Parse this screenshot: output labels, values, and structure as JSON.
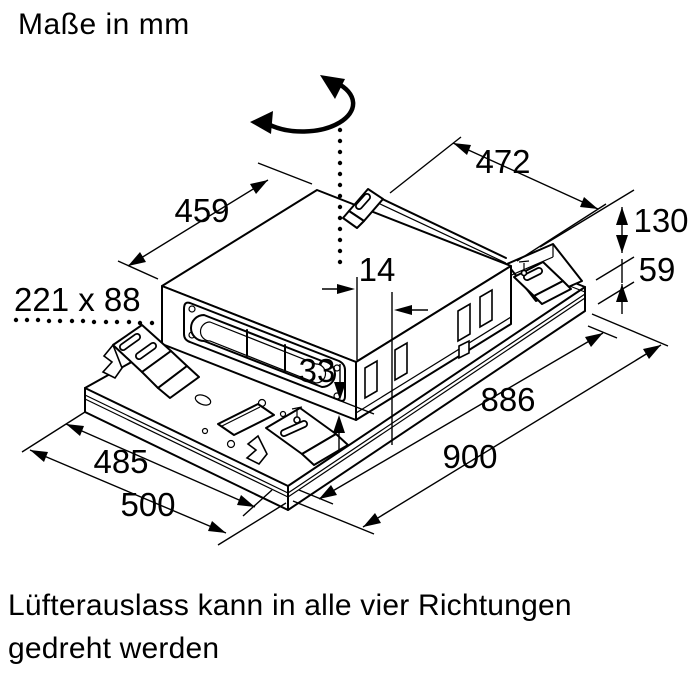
{
  "title": "Maße in mm",
  "caption": {
    "line1": "Lüfterauslass kann in alle vier Richtungen",
    "line2": "gedreht werden"
  },
  "dimensions": {
    "unit_depth": "459",
    "unit_width": "472",
    "unit_height": "130",
    "panel_height": "59",
    "outlet_offset": "14",
    "outlet_bottom_gap": "33",
    "duct_opening": "221 x 88",
    "panel_inner_length": "886",
    "panel_length": "900",
    "panel_inner_width": "485",
    "panel_width": "500"
  },
  "icons": {
    "rotation_arrow": "curved double-headed rotation arrow",
    "rotation_axis": "dotted vertical axis line"
  },
  "colors": {
    "line": "#000000",
    "background": "#ffffff"
  }
}
